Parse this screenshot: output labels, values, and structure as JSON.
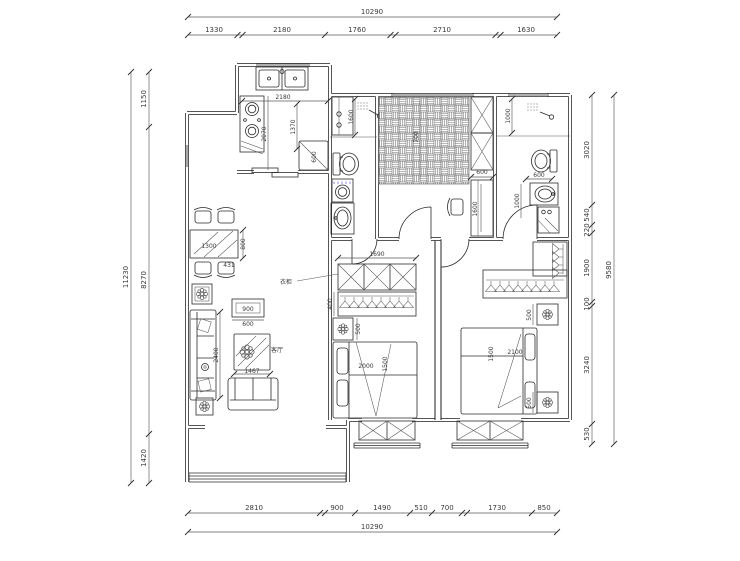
{
  "dims": {
    "top": {
      "total": "10290",
      "segs": [
        "1330",
        "2180",
        "1760",
        "2710",
        "1630"
      ]
    },
    "bottom": {
      "total": "10290",
      "segs": [
        "2810",
        "900",
        "1490",
        "510",
        "700",
        "1730",
        "850"
      ]
    },
    "left": {
      "total": "11230",
      "segs": [
        "1150",
        "8270",
        "1420"
      ]
    },
    "right": {
      "total": "9580",
      "segs": [
        "3020",
        "540",
        "220",
        "1900",
        "100",
        "3240",
        "530"
      ]
    }
  },
  "labels": {
    "kitchen_w": "2180",
    "kitchen_counter": "1370",
    "kitchen_d": "2070",
    "fridge": "600",
    "bath1_shower": "1600",
    "entry_hall": "700",
    "closet_w": "600",
    "desk_l": "1600",
    "bath2_shower": "1000",
    "bath2_wc": "600",
    "bath2_basin": "1000",
    "table_l": "1300",
    "table_w": "800",
    "chair_w": "431",
    "tv_w": "900",
    "tv_d": "600",
    "sofa_l": "2400",
    "coffee_w": "1467",
    "living_room": "客厅",
    "wardrobe_note": "衣柜",
    "wd1_w": "1690",
    "wd1_d": "400",
    "ns1": "500",
    "bed1_l": "2000",
    "bed1_w": "1500",
    "bed2_w": "1500",
    "bed2_l": "2100",
    "ns2_top": "500",
    "ns2_bottom": "500"
  }
}
